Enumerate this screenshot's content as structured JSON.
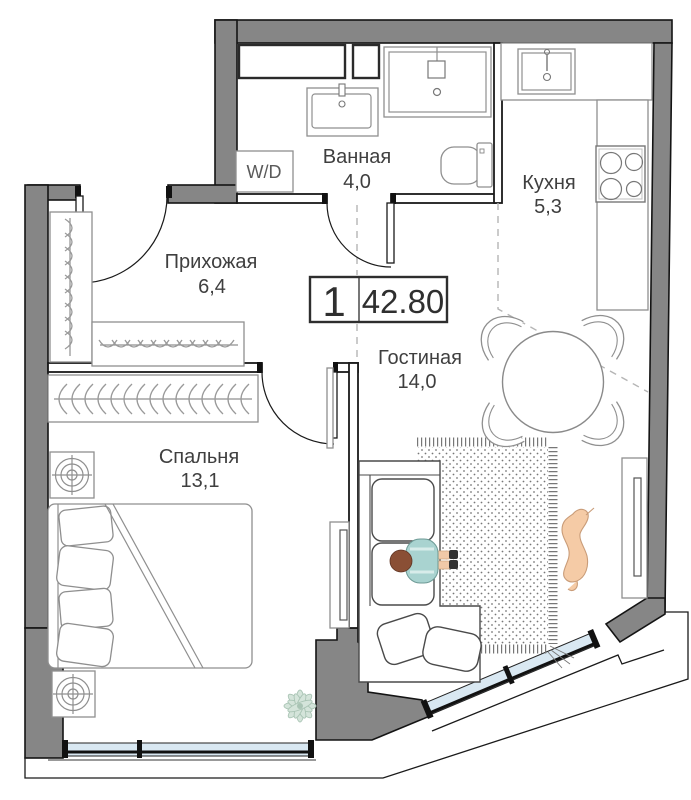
{
  "plan": {
    "badge": {
      "rooms": "1",
      "area": "42.80"
    },
    "rooms": {
      "bathroom": {
        "name": "Ванная",
        "area": "4,0"
      },
      "kitchen": {
        "name": "Кухня",
        "area": "5,3"
      },
      "hallway": {
        "name": "Прихожая",
        "area": "6,4"
      },
      "living": {
        "name": "Гостиная",
        "area": "14,0"
      },
      "bedroom": {
        "name": "Спальня",
        "area": "13,1"
      }
    },
    "appliances": {
      "washer_dryer": "W/D"
    },
    "icons": [
      "stove-icon",
      "sink-icon",
      "shower-icon",
      "toilet-icon",
      "washer-dryer-box",
      "wardrobe-hangers",
      "bed",
      "dining-table",
      "sofa",
      "rug",
      "tv-console",
      "nightstand-lamp",
      "plant",
      "person",
      "dog"
    ],
    "colors": {
      "wall": "#868686",
      "wall_outline": "#141414",
      "window_glass": "#d9e8f2",
      "furniture_line": "#8f8f8f",
      "sofa_line": "#4a4a4a",
      "label_text": "#3f3f3f",
      "person_shirt": "#a9d3d0",
      "person_hair": "#8a4f35",
      "person_skin": "#f0c9a8",
      "shoes": "#333333",
      "dog": "#f5cba6",
      "plant": "#d4e4da",
      "rug_dot": "#777777",
      "background": "#ffffff"
    }
  }
}
